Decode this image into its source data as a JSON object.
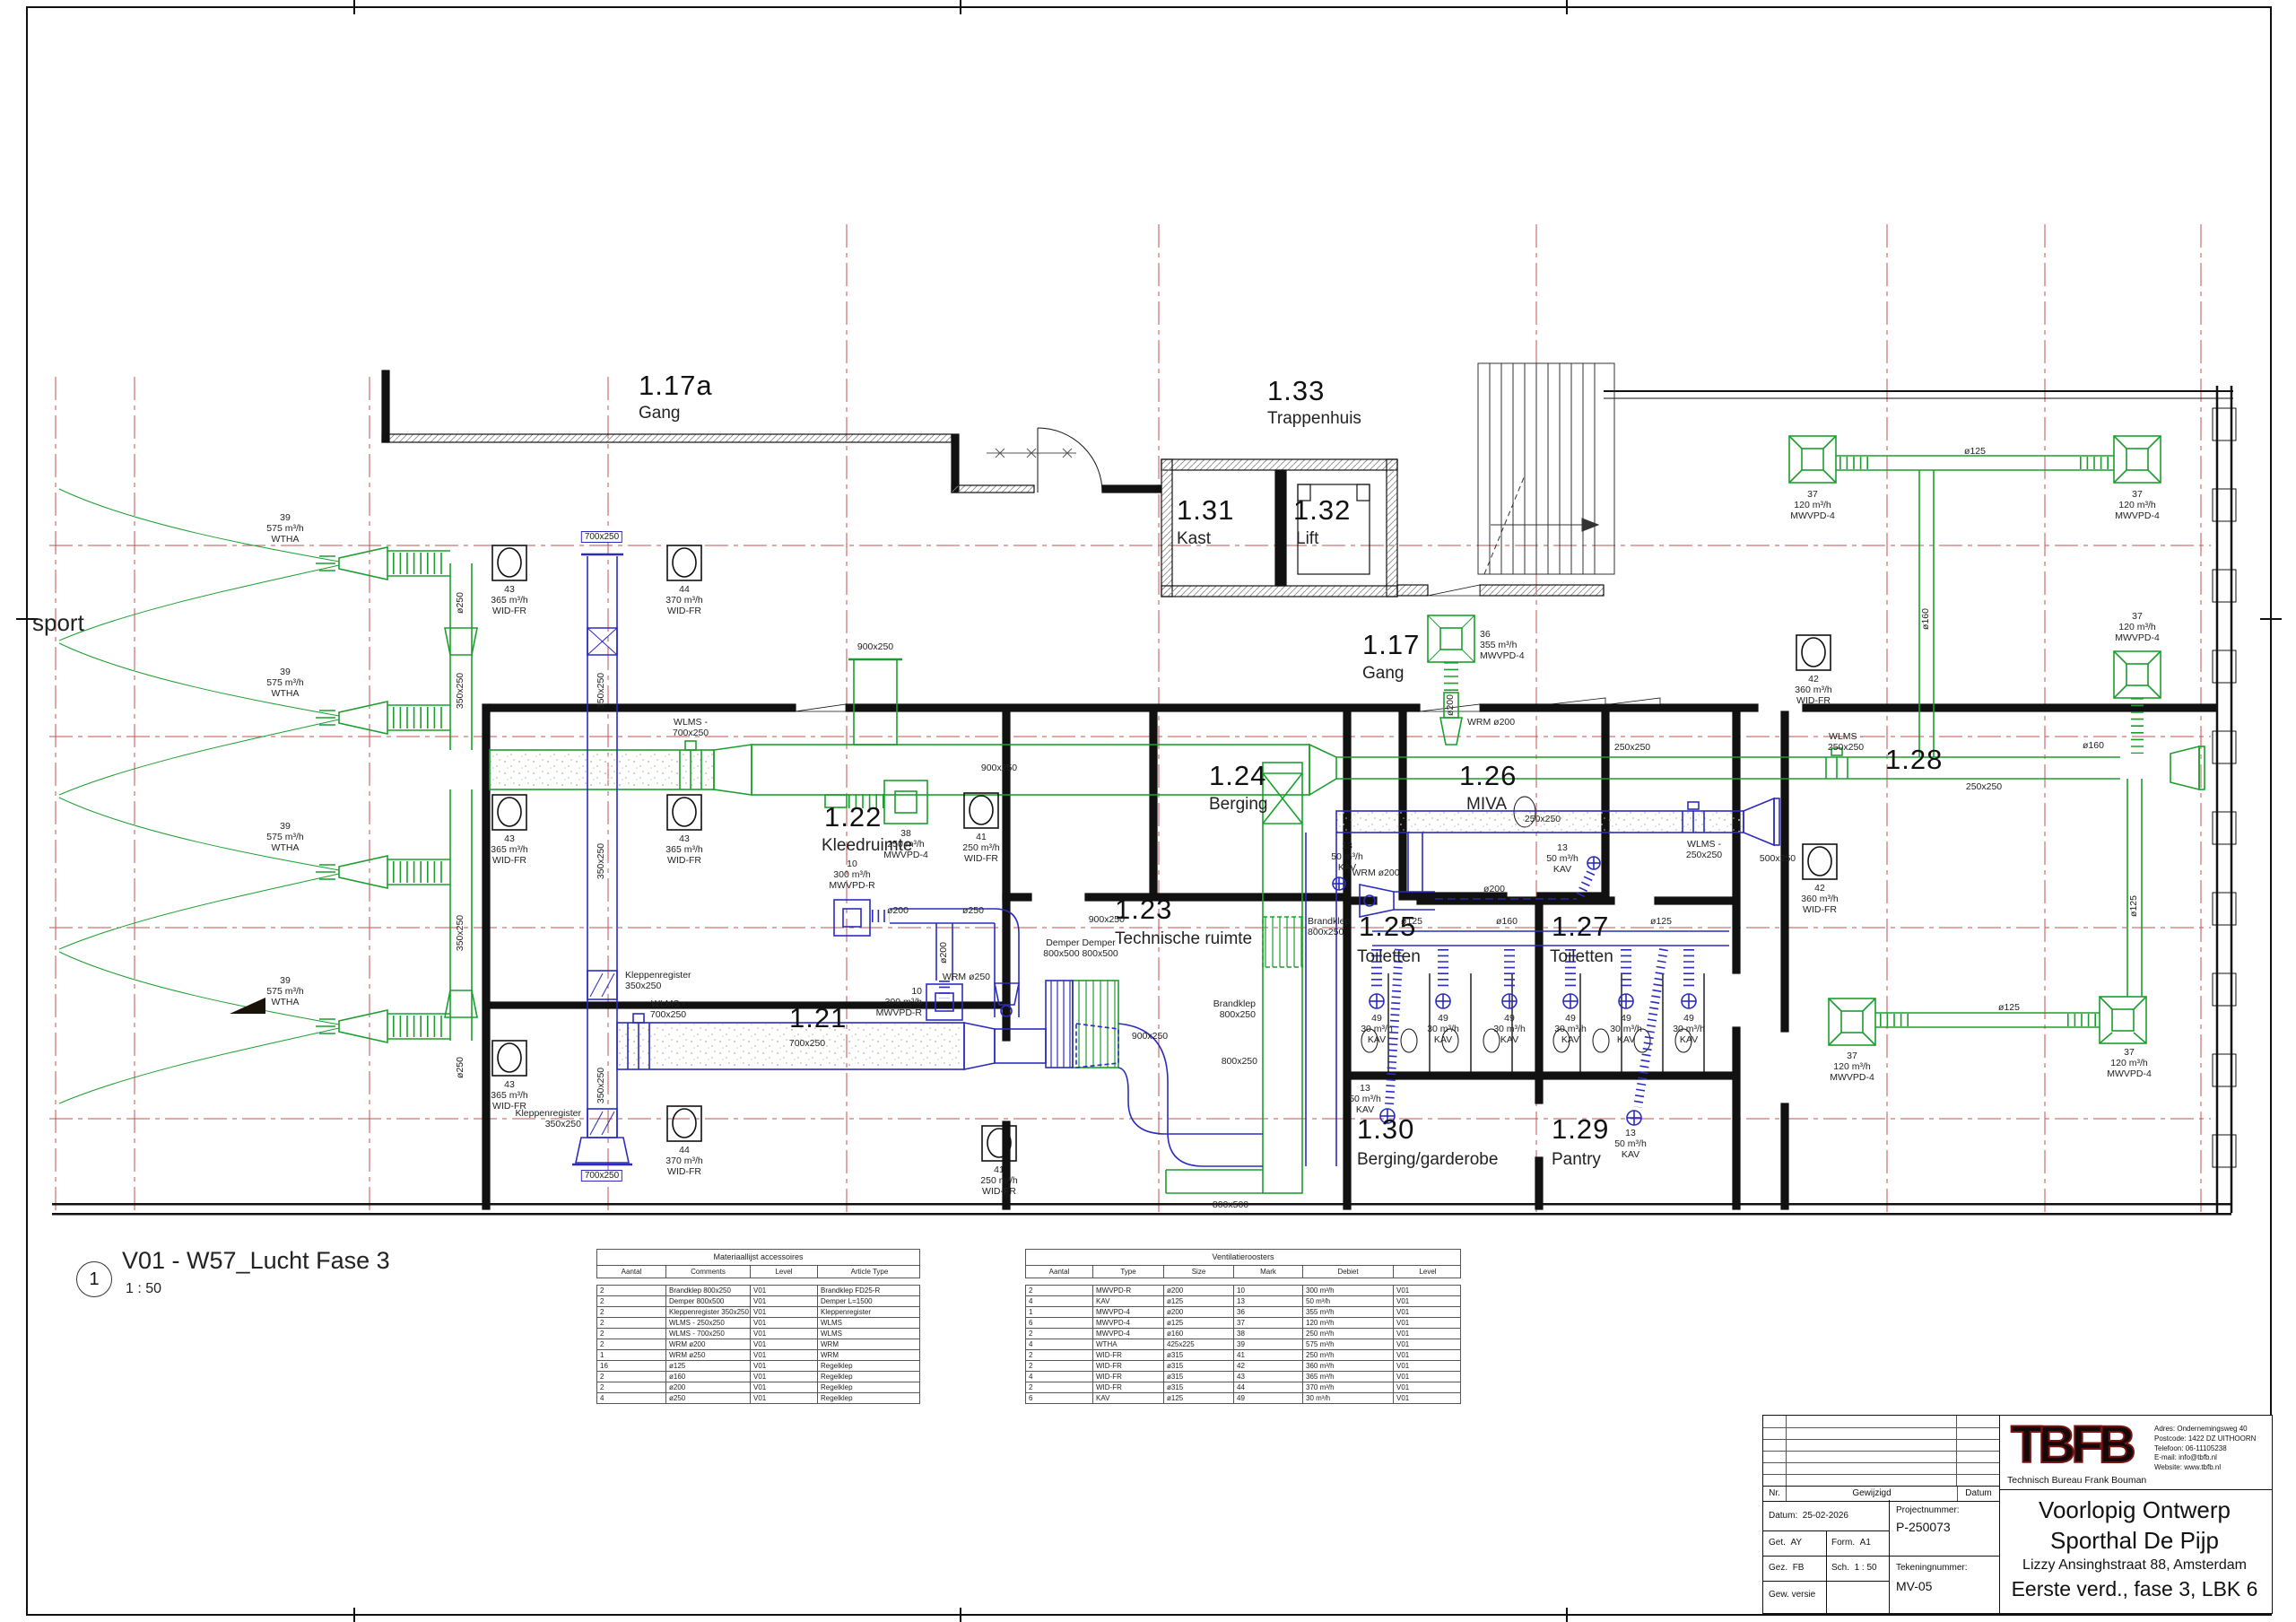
{
  "view_title": {
    "number": "1",
    "name": "V01 - W57_Lucht Fase 3",
    "scale": "1 : 50"
  },
  "annotations": {
    "hall": "sport"
  },
  "rooms": [
    {
      "num": "1.17a",
      "name": "Gang"
    },
    {
      "num": "1.33",
      "name": "Trappenhuis"
    },
    {
      "num": "1.31",
      "name": "Kast"
    },
    {
      "num": "1.32",
      "name": "Lift"
    },
    {
      "num": "1.17",
      "name": "Gang"
    },
    {
      "num": "1.24",
      "name": "Berging"
    },
    {
      "num": "1.26",
      "name": "MIVA"
    },
    {
      "num": "1.28",
      "name": ""
    },
    {
      "num": "1.22",
      "name": "Kleedruimte"
    },
    {
      "num": "1.23",
      "name": "Technische ruimte"
    },
    {
      "num": "1.25",
      "name": "Toiletten"
    },
    {
      "num": "1.27",
      "name": "Toiletten"
    },
    {
      "num": "1.21",
      "name": ""
    },
    {
      "num": "1.30",
      "name": "Berging/garderobe"
    },
    {
      "num": "1.29",
      "name": "Pantry"
    }
  ],
  "markers": {
    "wtha": "39\n575 m³/h\nWTHA",
    "wid41": "41\n250 m³/h\nWID-FR",
    "wid42": "42\n360 m³/h\nWID-FR",
    "wid43": "43\n365 m³/h\nWID-FR",
    "wid44": "44\n370 m³/h\nWID-FR",
    "mw36": "36\n355 m³/h\nMWVPD-4",
    "mw37": "37\n120 m³/h\nMWVPD-4",
    "mw38": "38\n250 m³/h\nMWVPD-4",
    "mwr10": "10\n300 m³/h\nMWVPD-R",
    "kav13": "13\n50 m³/h\nKAV",
    "kav49": "49\n30 m³/h\nKAV"
  },
  "ducts": {
    "d900": "900x250",
    "d700": "700x250",
    "d350": "350x250",
    "d250": "250x250",
    "d500": "500x250",
    "d800x500": "800x500",
    "d800x250": "800x250",
    "o125": "ø125",
    "o160": "ø160",
    "o200": "ø200",
    "o250": "ø250",
    "wlms700": "WLMS -\n700x250",
    "wlms250": "WLMS -\n250x250",
    "wrm200": "WRM ø200",
    "wrm250": "WRM ø250",
    "klep": "Kleppenregister\n350x250",
    "demper": "Demper Demper\n800x500 800x500",
    "brandklep": "Brandklep\n800x250"
  },
  "tables": {
    "materials": {
      "title": "Materiaallijst accessoires",
      "headers": [
        "Aantal",
        "Comments",
        "Level",
        "Article Type"
      ],
      "rows": [
        [
          "2",
          "Brandklep 800x250",
          "V01",
          "Brandklep FD25-R"
        ],
        [
          "2",
          "Demper 800x500",
          "V01",
          "Demper L=1500"
        ],
        [
          "2",
          "Kleppenregister 350x250",
          "V01",
          "Kleppenregister"
        ],
        [
          "2",
          "WLMS - 250x250",
          "V01",
          "WLMS"
        ],
        [
          "2",
          "WLMS - 700x250",
          "V01",
          "WLMS"
        ],
        [
          "2",
          "WRM ø200",
          "V01",
          "WRM"
        ],
        [
          "1",
          "WRM ø250",
          "V01",
          "WRM"
        ],
        [
          "16",
          "ø125",
          "V01",
          "Regelklep"
        ],
        [
          "2",
          "ø160",
          "V01",
          "Regelklep"
        ],
        [
          "2",
          "ø200",
          "V01",
          "Regelklep"
        ],
        [
          "4",
          "ø250",
          "V01",
          "Regelklep"
        ]
      ]
    },
    "grilles": {
      "title": "Ventilatieroosters",
      "headers": [
        "Aantal",
        "Type",
        "Size",
        "Mark",
        "Debiet",
        "Level"
      ],
      "rows": [
        [
          "2",
          "MWVPD-R",
          "ø200",
          "10",
          "300 m³/h",
          "V01"
        ],
        [
          "4",
          "KAV",
          "ø125",
          "13",
          "50 m³/h",
          "V01"
        ],
        [
          "1",
          "MWVPD-4",
          "ø200",
          "36",
          "355 m³/h",
          "V01"
        ],
        [
          "6",
          "MWVPD-4",
          "ø125",
          "37",
          "120 m³/h",
          "V01"
        ],
        [
          "2",
          "MWVPD-4",
          "ø160",
          "38",
          "250 m³/h",
          "V01"
        ],
        [
          "4",
          "WTHA",
          "425x225",
          "39",
          "575 m³/h",
          "V01"
        ],
        [
          "2",
          "WID-FR",
          "ø315",
          "41",
          "250 m³/h",
          "V01"
        ],
        [
          "2",
          "WID-FR",
          "ø315",
          "42",
          "360 m³/h",
          "V01"
        ],
        [
          "4",
          "WID-FR",
          "ø315",
          "43",
          "365 m³/h",
          "V01"
        ],
        [
          "2",
          "WID-FR",
          "ø315",
          "44",
          "370 m³/h",
          "V01"
        ],
        [
          "6",
          "KAV",
          "ø125",
          "49",
          "30 m³/h",
          "V01"
        ]
      ]
    }
  },
  "title_block": {
    "logo": "TBFB",
    "company": "Technisch Bureau Frank Bouman",
    "address": [
      [
        "Adres:",
        "Ondernemingsweg 40"
      ],
      [
        "Postcode:",
        "1422 DZ UITHOORN"
      ],
      [
        "Telefoon:",
        "06-11105238"
      ],
      [
        "E-mail:",
        "info@tbfb.nl"
      ],
      [
        "Website:",
        "www.tbfb.nl"
      ]
    ],
    "rev_headers": {
      "nr": "Nr.",
      "gewijzigd": "Gewijzigd",
      "datum": "Datum"
    },
    "fields": {
      "datum_label": "Datum:",
      "datum": "25-02-2026",
      "get_label": "Get.",
      "get": "AY",
      "form_label": "Form.",
      "form": "A1",
      "gez_label": "Gez.",
      "gez": "FB",
      "sch_label": "Sch.",
      "sch": "1 : 50",
      "gew": "Gew. versie",
      "proj_label": "Projectnummer:",
      "proj": "P-250073",
      "tek_label": "Tekeningnummer:",
      "tek": "MV-05"
    },
    "titles": {
      "status": "Voorlopig Ontwerp",
      "project": "Sporthal De Pijp",
      "address_line": "Lizzy Ansinghstraat 88, Amsterdam",
      "sheet": "Eerste verd., fase 3, LBK 6"
    }
  }
}
